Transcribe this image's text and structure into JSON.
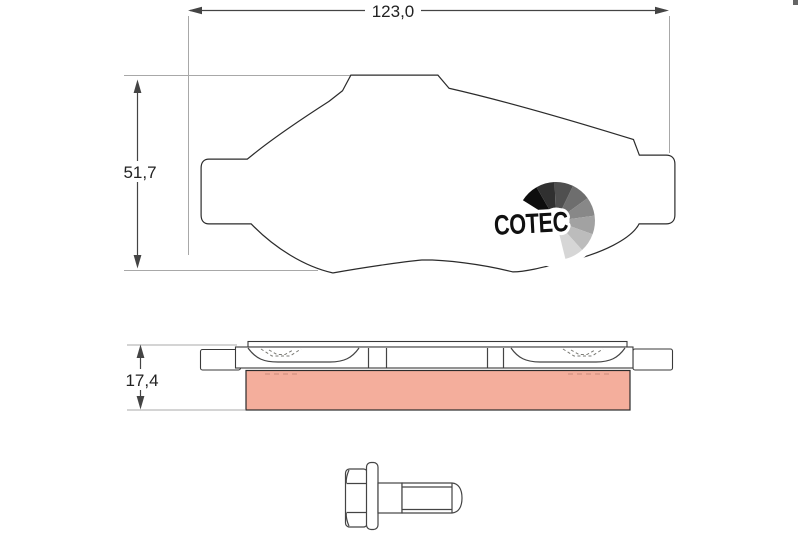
{
  "meta": {
    "description": "Technical drawing of a COTEC disc brake pad with side profile and flange mounting bolt"
  },
  "dimensions": {
    "width": "123,0",
    "height": "51,7",
    "thickness": "17,4"
  },
  "logo": {
    "brand": "COTEC"
  },
  "colors": {
    "background": "#ffffff",
    "friction": "#f3a996",
    "friction_side": "#f4ae9c",
    "outline": "#2b2b2b",
    "drawing_line": "#444444",
    "extension_line": "#a8a8a8",
    "dashed_marking": "#8f8f8a",
    "contour_dash": "#b08575",
    "pink_dash": "#c9897a",
    "logo_text": "#101010",
    "logo_wedges": [
      "#0d0d0d",
      "#303030",
      "#4f4f4f",
      "#6e6e6e",
      "#888888",
      "#a2a2a2",
      "#bcbcbc",
      "#d6d6d6"
    ]
  }
}
